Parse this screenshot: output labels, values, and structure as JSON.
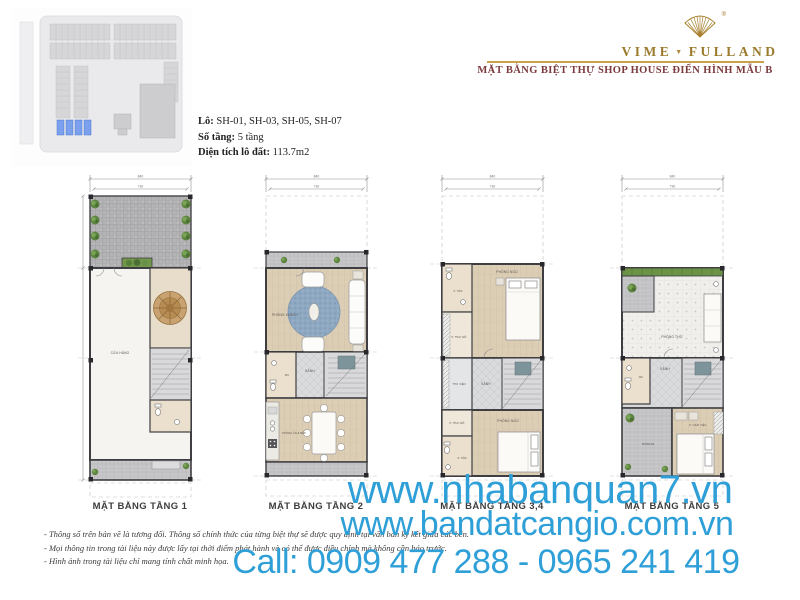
{
  "header": {
    "brand_left": "VIME",
    "brand_right": "FULLAND",
    "brand_separator": "▼",
    "registered": "®",
    "subtitle": "MẶT BẰNG BIỆT THỰ SHOP HOUSE  ĐIỂN HÌNH MẪU B",
    "brand_color": "#9c7a2c",
    "subtitle_color": "#7c3a3d"
  },
  "property_info": {
    "lot_label": "Lô:",
    "lot_value": " SH-01, SH-03, SH-05, SH-07",
    "floors_label": "Số tầng:",
    "floors_value": " 5 tầng",
    "area_label": "Diện tích lô đất:",
    "area_value": " 113.7m2"
  },
  "site_plan": {
    "highlight_color": "#7aa0ee"
  },
  "plans": [
    {
      "label": "MẶT BẰNG TẦNG 1",
      "dim_total": "840",
      "dim_inner": "730",
      "rooms": {
        "shop": "CỬA HÀNG"
      }
    },
    {
      "label": "MẶT BẰNG TẦNG 2",
      "dim_total": "840",
      "dim_inner": "730",
      "rooms": {
        "living": "PHÒNG KHÁCH",
        "hall": "SẢNH",
        "wc": "WC",
        "dining": "PHÒNG ĂN & BẾP"
      }
    },
    {
      "label": "MẶT BẰNG TẦNG 3,4",
      "dim_total": "840",
      "dim_inner": "730",
      "rooms": {
        "bath_top": "P. TẮM",
        "bedroom_top": "PHÒNG NGỦ",
        "dressing_top": "P. THAY ĐỒ",
        "library": "THƯ VIỆN",
        "hall": "SẢNH",
        "dressing_bottom": "P. THAY ĐỒ",
        "bedroom_bottom": "PHÒNG NGỦ",
        "bath_bottom": "P. TẮM"
      }
    },
    {
      "label": "MẶT BẰNG TẦNG 5",
      "dim_total": "840",
      "dim_inner": "730",
      "rooms": {
        "worship": "PHÒNG THỜ",
        "wc": "WC",
        "hall": "SẢNH",
        "terrace": "TERRACE",
        "maid": "P. GIÚP VIỆC"
      }
    }
  ],
  "notes": {
    "n1": "- Thông số trên bản vẽ là tương đối. Thông số chính thức của từng biệt thự sẽ được quy định tại văn bản ký kết giữa các bên.",
    "n2": "- Mọi thông tin trong tài liệu này được lấy tại thời điểm phát hành và có thể được điều chỉnh mà không cần báo trước.",
    "n3": "- Hình ảnh trong tài liệu chỉ mang tính chất minh họa."
  },
  "watermark": {
    "line1": "www.nhabanquan7.vn",
    "line2": "www.bandatcangio.com.vn",
    "line3": "Call: 0909 477 288 - 0965 241 419",
    "color": "#2f9fd8"
  }
}
